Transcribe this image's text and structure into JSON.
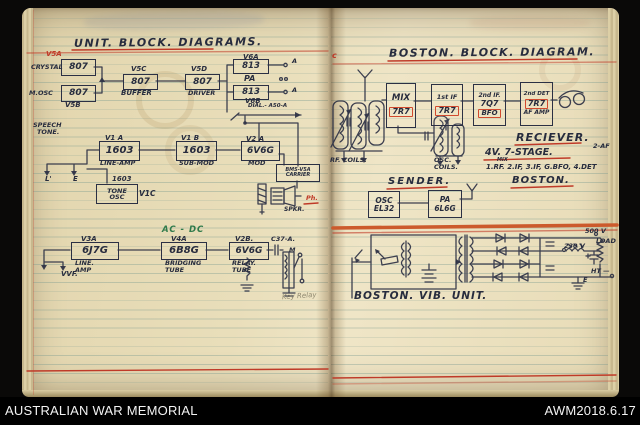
{
  "colors": {
    "red_ink": "#bf3a28",
    "green_ink": "#2f7a4b",
    "blue_black_ink": "#272c3e",
    "orange_rule": "#cc5a2c",
    "paper": "#e9debc"
  },
  "footer": {
    "archive": "AUSTRALIAN WAR MEMORIAL",
    "item_id": "AWM2018.6.17"
  },
  "l": {
    "title": "UNIT. BLOCK. DIAGRAMS.",
    "v5a": "V5A",
    "crystal": "CRYSTAL",
    "t807a": "807",
    "mosc": "M.OSC",
    "t807b": "807",
    "v5b": "V5B",
    "v5c": "V5C",
    "t807c": "807",
    "buffer": "BUFFER",
    "v5d": "V5D",
    "t807d": "807",
    "driver": "DRIVER",
    "v6a": "V6A",
    "t813a": "813",
    "pa": "PA",
    "t813b": "813",
    "v6b": "V6B",
    "a1": "A",
    "a2": "A",
    "dial": "DIAL.- A50-A",
    "speech": "SPEECH",
    "tone": "TONE.",
    "v1a": "V1 A",
    "t1603a": "1603",
    "lineamp": "LINE-AMP",
    "v1b": "V1 B",
    "t1603b": "1603",
    "submod": "SUB-MOD",
    "v2a": "V2 A",
    "t6v6g": "6V6G",
    "mod": "MOD",
    "l_in": "L'",
    "e_in": "E",
    "t1603c": "1603",
    "toneosc1": "TONE",
    "toneosc2": "OSC",
    "v1c": "V1C",
    "bms1": "BMS-V5A",
    "bms2": "CARRIER",
    "ph": "Ph.",
    "spkr": "SPKR.",
    "acdc": "AC - DC",
    "v3a": "V3A",
    "t6j7g": "6J7G",
    "lineamp2a": "LINE.",
    "lineamp2b": "AMP",
    "v4a": "V4A",
    "t6b8g": "6B8G",
    "bridging1": "BRIDGING",
    "bridging2": "TUBE",
    "v2b": "V2B.",
    "t6v6g2": "6V6G",
    "relay1": "RELAY.",
    "relay2": "TUBE",
    "c37a": "C37-A.",
    "m_lbl": "M",
    "vvf": "VVF.",
    "keyrelay": "Key Relay"
  },
  "r": {
    "margin": "c",
    "title": "BOSTON. BLOCK. DIAGRAM.",
    "mix": "MIX",
    "mixtube": "7R7",
    "if1": "1st IF",
    "if1tube": "7R7",
    "if2": "2nd IF.",
    "if2tube": "7Q7",
    "bfo": "BFO",
    "det": "2nd DET",
    "dettube": "7R7",
    "afamp": "AF AMP",
    "rfcoils": "RF. COILS.",
    "osccoils1": "OSC.",
    "osccoils2": "COILS.",
    "reciever": "RECIEVER.",
    "af2": "2-AF",
    "stages": "4V. 7-STAGE.",
    "mixsmall": "MIX",
    "stages2": "1.RF. 2.IF, 3.IF, G.BFO, 4.DET",
    "sender": "SENDER.",
    "boston": "BOSTON.",
    "osc": "OSC",
    "osctube": "EL32",
    "pa": "PA",
    "patube": "6L6G",
    "v500": "500 V",
    "load": "LOAD",
    "v230": "230 V",
    "ht": "HT —",
    "e_lbl": "E",
    "caption": "BOSTON. VIB. UNIT."
  }
}
